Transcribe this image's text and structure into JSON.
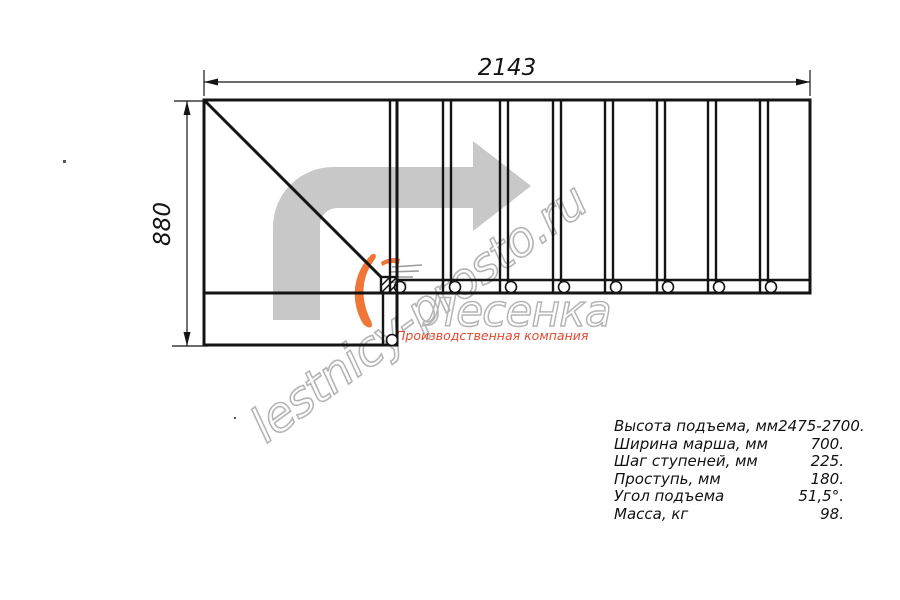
{
  "diagram": {
    "type": "staircase-plan-top-view",
    "straight_steps": 8,
    "has_turn_landing": true,
    "direction": "up then turn right",
    "dimensions": {
      "width_label": "2143",
      "height_label": "880"
    }
  },
  "specs": {
    "rows": [
      {
        "label": "Высота подъема, мм",
        "value": "2475-2700."
      },
      {
        "label": "Ширина марша, мм",
        "value": "700."
      },
      {
        "label": "Шаг ступеней, мм",
        "value": "225."
      },
      {
        "label": "Проступь, мм",
        "value": "180."
      },
      {
        "label": "Угол подъема",
        "value": "51,5°."
      },
      {
        "label": "Масса, кг",
        "value": "98."
      }
    ]
  },
  "watermark": {
    "site": "lestnicy-prosto.ru",
    "brand": "Лесенка",
    "tagline": "Производственная компания"
  },
  "colors": {
    "ink": "#141414",
    "arrow-gray": "#c8c8c8",
    "wm-gray": "#b5b5b5",
    "brand-red": "#e2492f",
    "flame-orange": "#f07637"
  }
}
